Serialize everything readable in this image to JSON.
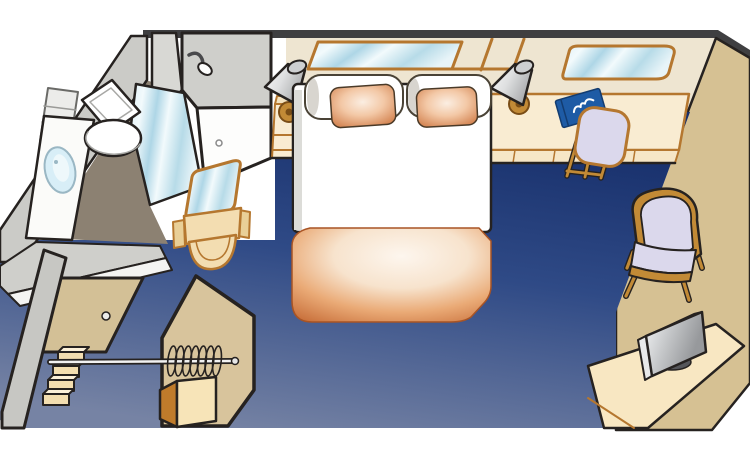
{
  "page": {
    "title": "Cruise ship interior stateroom floor plan (cutaway illustration)",
    "canvas_width": 750,
    "canvas_height": 460,
    "background": "#ffffff",
    "visible_text": []
  },
  "scene": {
    "projection": "oblique-cutaway",
    "rooms": [
      "bathroom",
      "entry-closet",
      "sleeping-lounge-area"
    ],
    "furniture": [
      "entry-door",
      "wardrobe-rail-with-hangers",
      "personal-safe",
      "storage-steps",
      "toilet",
      "washbasin-counter",
      "bathroom-shelves",
      "shower-with-glass-door",
      "shower-head",
      "vanity-mirror-cabinet",
      "double-bed",
      "pillows",
      "overbed-mirror",
      "nightstand-with-lamp",
      "desk-with-drawers",
      "desk-lamp",
      "guidebook",
      "desk-chair",
      "desk-mirror",
      "armchair",
      "tv-cabinet",
      "flat-screen-tv"
    ]
  },
  "colors": {
    "outline": "#262220",
    "band": "#3f3f41",
    "back_wall": "#eee5d1",
    "right_wall": "#d6c193",
    "wood": "#b5772f",
    "wood_bright": "#c28a36",
    "floor_dark": "#172f6b",
    "floor_mid": "#2f4a86",
    "floor_light": "#7683a4",
    "bath_floor": "#8c8172",
    "wall_gray": "#cfcfcb",
    "wall_gray_light": "#d8d8d4",
    "glass_hi": "#f2fafc",
    "glass_mid": "#aed6e6",
    "white": "#ffffff",
    "cream": "#f9ecd2",
    "cream_mid": "#f3ddb1",
    "door_tan": "#d3c096",
    "closet_tan": "#d8c49c",
    "safe_side": "#bf7b2b",
    "safe_front": "#f7e4b8",
    "step_tan": "#f3deb0",
    "cabinet_tan": "#f8e7c2",
    "peach_dark": "#c86f3a",
    "peach_mid": "#f3c8a6",
    "peach_light": "#fdf6ee",
    "lavender": "#dbd8ec",
    "book_blue": "#1e5ba5",
    "tv_dark": "#55565a",
    "tv_mid": "#c9cbcd",
    "shade_light": "#fafafa",
    "shade_dark": "#a9abad"
  }
}
